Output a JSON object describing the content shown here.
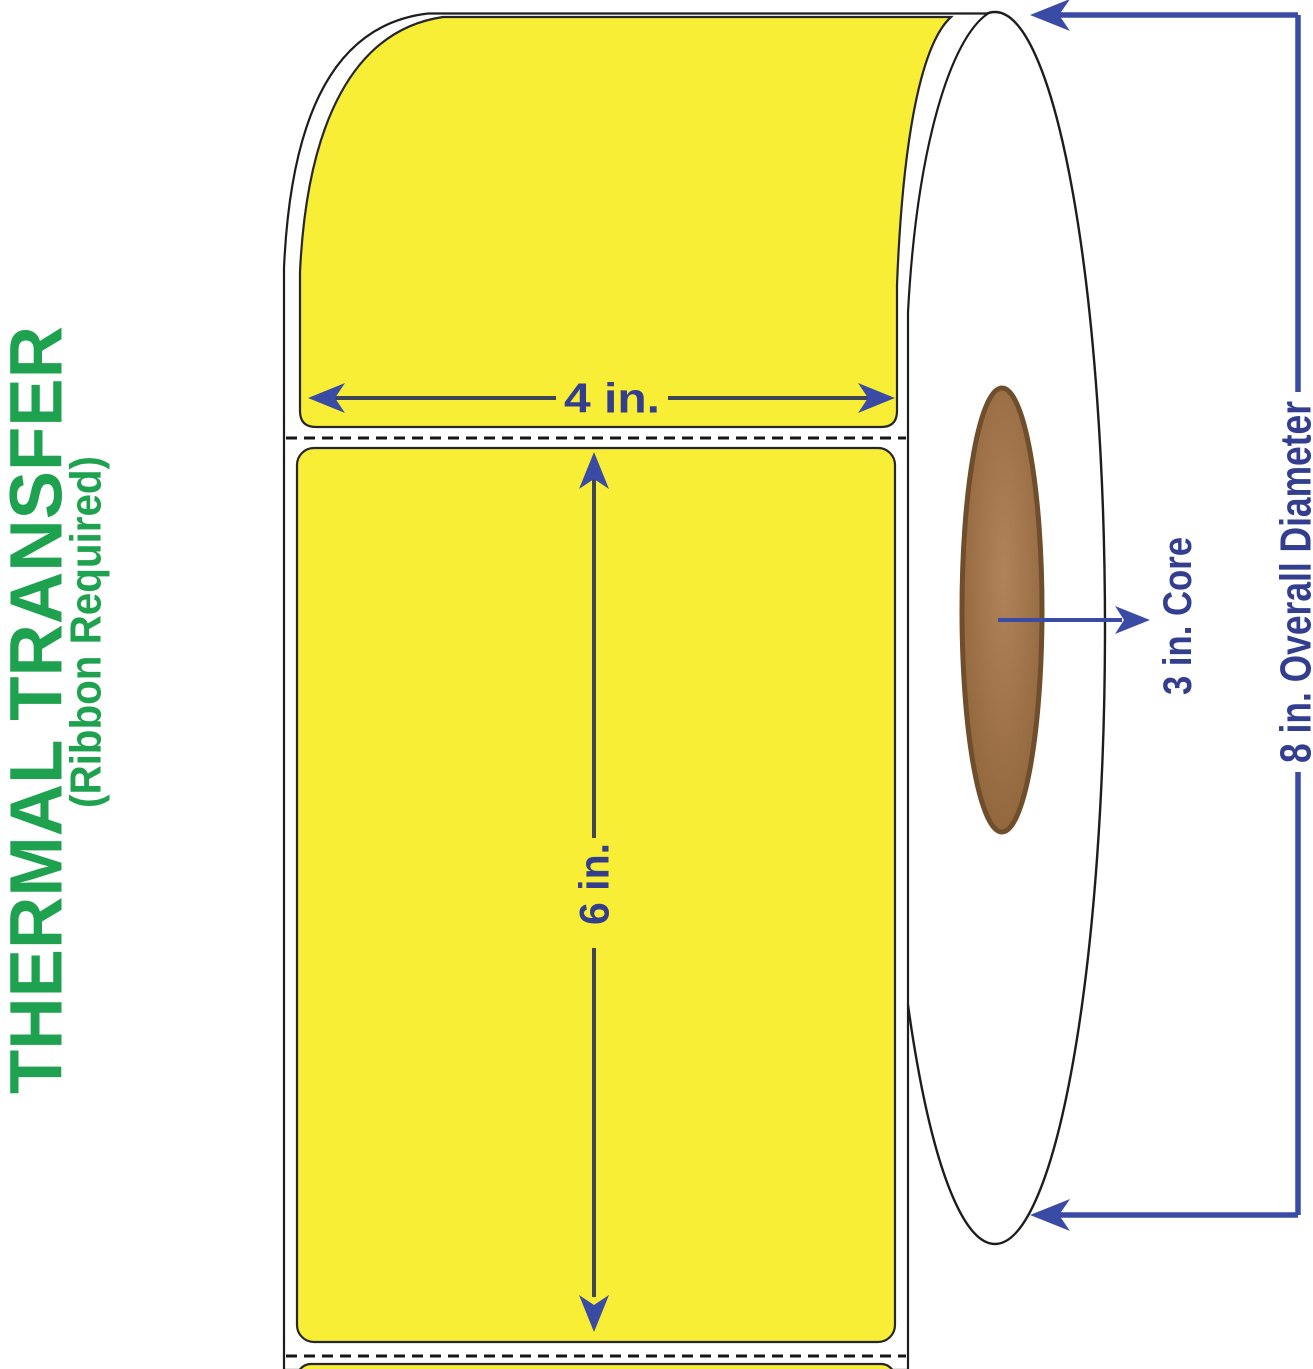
{
  "diagram_title": "Thermal transfer label roll with dimensions",
  "side_text": {
    "primary": "THERMAL TRANSFER",
    "secondary": "(Ribbon Required)",
    "color": "#1fa24f"
  },
  "dimensions": {
    "label_width": "4 in.",
    "label_length": "6 in.",
    "core": "3 in. Core",
    "overall_diameter": "8 in. Overall Diameter"
  },
  "colors": {
    "label_yellow": "#f8ee35",
    "navy_text": "#333e8f",
    "arrow_blue": "#3a4ba6",
    "dim_line_dark": "#3e4557",
    "outline_black": "#26262b",
    "green": "#1fa24f",
    "core_brown_light": "#b2835a",
    "core_brown_dark": "#8a6036",
    "core_border": "#6f4e2b",
    "roll_white": "#ffffff"
  }
}
